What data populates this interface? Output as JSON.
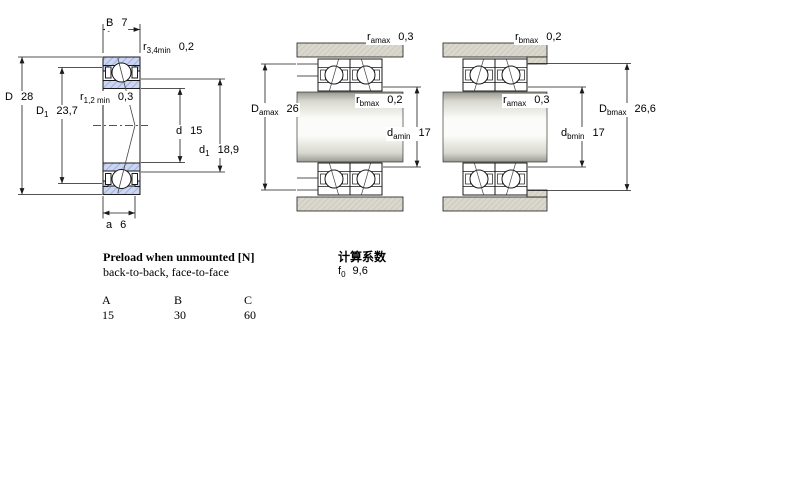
{
  "diagrams": {
    "left": {
      "description": "single angular contact bearing cross-section",
      "dims": {
        "B": {
          "base": "B",
          "sub": "",
          "value": "7"
        },
        "r34": {
          "base": "r",
          "sub": "3,4min",
          "value": "0,2"
        },
        "D": {
          "base": "D",
          "sub": "",
          "value": "28"
        },
        "r12": {
          "base": "r",
          "sub": "1,2 min",
          "value": "0,3"
        },
        "D1": {
          "base": "D",
          "sub": "1",
          "value": "23,7"
        },
        "d": {
          "base": "d",
          "sub": "",
          "value": "15"
        },
        "d1": {
          "base": "d",
          "sub": "1",
          "value": "18,9"
        },
        "a": {
          "base": "a",
          "sub": "",
          "value": "6"
        }
      }
    },
    "middle": {
      "description": "paired bearings mounted, a-side abutment dimensions",
      "dims": {
        "ramax": {
          "base": "r",
          "sub": "amax",
          "value": "0,3"
        },
        "Damax": {
          "base": "D",
          "sub": "amax",
          "value": "26"
        },
        "rbmax": {
          "base": "r",
          "sub": "bmax",
          "value": "0,2"
        },
        "damin": {
          "base": "d",
          "sub": "amin",
          "value": "17"
        }
      }
    },
    "right": {
      "description": "paired bearings mounted, b-side abutment dimensions",
      "dims": {
        "rbmax": {
          "base": "r",
          "sub": "bmax",
          "value": "0,2"
        },
        "ramax": {
          "base": "r",
          "sub": "amax",
          "value": "0,3"
        },
        "Dbmax": {
          "base": "D",
          "sub": "bmax",
          "value": "26,6"
        },
        "dbmin": {
          "base": "d",
          "sub": "bmin",
          "value": "17"
        }
      }
    }
  },
  "preload": {
    "title": "Preload when unmounted [N]",
    "subtitle": "back-to-back, face-to-face",
    "columns": [
      "A",
      "B",
      "C"
    ],
    "values": [
      "15",
      "30",
      "60"
    ]
  },
  "calc": {
    "title": "计算系数",
    "f0": {
      "base": "f",
      "sub": "0",
      "value": "9,6"
    }
  },
  "colors": {
    "ring_fill": "#ccd6f2",
    "ring_hatch": "#8aa0d8",
    "housing_fill": "#dad7cd",
    "housing_hatch": "#c0bdb2",
    "line": "#1a1a1a"
  }
}
